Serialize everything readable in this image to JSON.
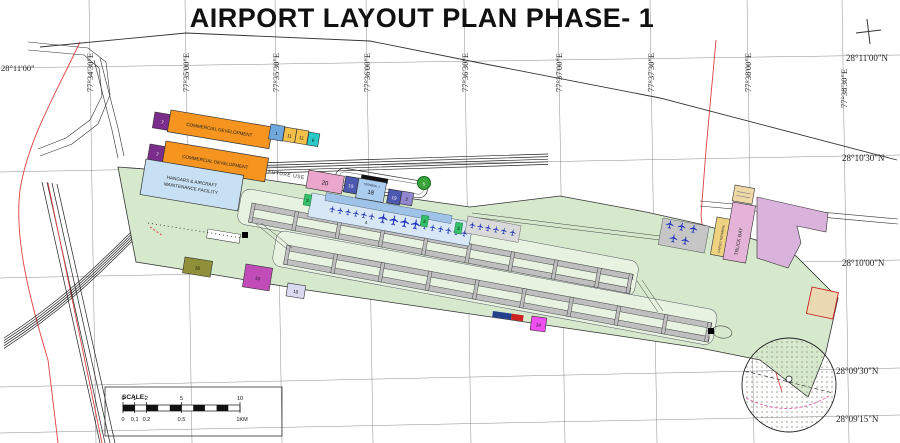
{
  "title": "AIRPORT LAYOUT PLAN PHASE- 1",
  "graticule": {
    "longitudes": [
      "77°34'30\"E",
      "77°35'00\"E",
      "77°35'30\"E",
      "77°36'00\"E",
      "77°36'30\"E",
      "77°37'00\"E",
      "77°37'30\"E",
      "77°38'00\"E",
      "77°38'30\"E"
    ],
    "latitudes_right": [
      "28°11'00\"N",
      "28°10'30\"N",
      "28°10'00\"N",
      "28°09'30\"N",
      "28°09'15\"N"
    ],
    "latitude_left": "28°11'00\""
  },
  "areas": {
    "commercial1": "COMMERCIAL DEVELOPMENT",
    "commercial2": "COMMERCIAL DEVELOPMENT",
    "hangars_line1": "HANGARS & AIRCRAFT",
    "hangars_line2": "MAINTENANCE FACILITY",
    "future_use": "FUTURE USE",
    "terminal_small": "TERMINAL 1",
    "truck_bay": "TRUCK BAY",
    "cargo_terminal": "CARGO TERMINAL"
  },
  "parcels": {
    "n1": "1",
    "n2": "2",
    "n3": "3",
    "n4": "4",
    "n5": "5",
    "n6": "6",
    "n7": "7",
    "n10": "10",
    "n11": "11",
    "n13": "13",
    "n14": "14",
    "n16": "16",
    "n18": "18",
    "n19": "19",
    "n20": "20"
  },
  "scale": {
    "label": "SCALE:",
    "top_ticks": [
      "0",
      "1",
      "2",
      "5",
      "10"
    ],
    "bottom_ticks": [
      "0",
      "0.1",
      "0.2",
      "0.5",
      "1KM"
    ]
  },
  "icons": {
    "aircraft": "airplane-silhouette",
    "survey_cross": "+",
    "roundabout": "green-circle"
  },
  "colors": {
    "land_green": "#d6e9cd",
    "strip_green": "#e7f3e0",
    "pavement_gray": "#bfbfbf",
    "commercial_orange": "#f5941f",
    "terminal_blue": "#aacdf0",
    "apron_blue": "#d7e7f6",
    "aircraft_blue": "#2233bb",
    "parcel_purple": "#7b2d8b",
    "parcel_yellow": "#f3c14b",
    "parcel_cyan": "#2cc9c9",
    "parcel_pink": "#eaa6cc",
    "parcel_darkblue": "#4d58b0",
    "parcel_olive": "#90903a",
    "parcel_magenta": "#c14cb8",
    "truckbay_pink": "#e4b3d7",
    "cargo_yellow": "#efd27f",
    "mauve": "#d9b3db",
    "alert_red": "#e04040"
  }
}
